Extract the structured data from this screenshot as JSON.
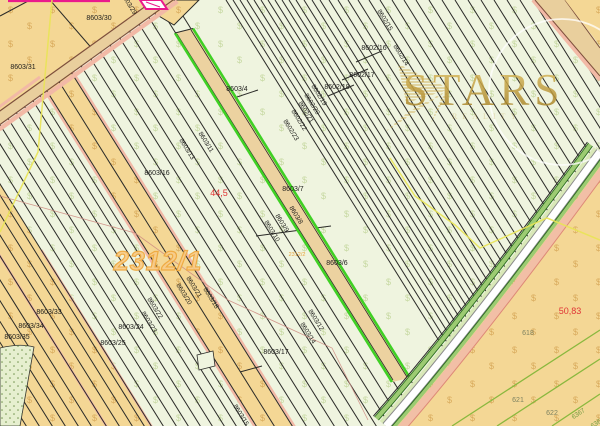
{
  "watermark": {
    "title": "STARS",
    "subtitle": "REALITY"
  },
  "map": {
    "texture_symbol": "$",
    "zone_number": "2312/1",
    "highlighted_parcel": "8603/8",
    "colors": {
      "field": "#eff4df",
      "orchard": "#f4d795",
      "road_fill": "#e9cf9d",
      "road_edge": "#7d4f3c",
      "pink_edge": "#f2b9a6",
      "magenta": "#ea1a8c",
      "highlight_green": "#3fd024",
      "bottom_field": "#f6dda2",
      "bottom_parcel_line": "#8ab83e",
      "gold": "#bd9833",
      "yellow_line": "#e9e455",
      "red_text": "#e03535",
      "zone_orange": "#efa93f"
    },
    "labels": [
      {
        "t": "8603/30",
        "x": 99,
        "y": 19,
        "r": 0,
        "s": "std"
      },
      {
        "t": "8603/31",
        "x": 23,
        "y": 68,
        "r": 0,
        "s": "std"
      },
      {
        "t": "8603/16",
        "x": 157,
        "y": 174,
        "r": 0,
        "s": "std"
      },
      {
        "t": "8603/4",
        "x": 237,
        "y": 90,
        "r": 0,
        "s": "std"
      },
      {
        "t": "8603/7",
        "x": 293,
        "y": 190,
        "r": 0,
        "s": "std"
      },
      {
        "t": "8603/6",
        "x": 337,
        "y": 264,
        "r": 0,
        "s": "std"
      },
      {
        "t": "8602/16",
        "x": 374,
        "y": 49,
        "r": 0,
        "s": "std"
      },
      {
        "t": "8602/17",
        "x": 362,
        "y": 76,
        "r": 0,
        "s": "std"
      },
      {
        "t": "8602/18",
        "x": 337,
        "y": 88,
        "r": 0,
        "s": "std"
      },
      {
        "t": "8603/17",
        "x": 276,
        "y": 353,
        "r": 0,
        "s": "std"
      },
      {
        "t": "8603/24",
        "x": 131,
        "y": 328,
        "r": 0,
        "s": "std"
      },
      {
        "t": "8603/25",
        "x": 113,
        "y": 344,
        "r": 0,
        "s": "std"
      },
      {
        "t": "8603/33",
        "x": 49,
        "y": 313,
        "r": 0,
        "s": "std"
      },
      {
        "t": "8603/34",
        "x": 31,
        "y": 327,
        "r": 0,
        "s": "std"
      },
      {
        "t": "8603/35",
        "x": 17,
        "y": 338,
        "r": 0,
        "s": "std"
      },
      {
        "t": "618",
        "x": 528,
        "y": 334,
        "r": 0,
        "s": "olive"
      },
      {
        "t": "621",
        "x": 518,
        "y": 401,
        "r": 0,
        "s": "olive"
      },
      {
        "t": "622",
        "x": 552,
        "y": 414,
        "r": 0,
        "s": "olive"
      },
      {
        "t": "8602/15",
        "x": 384,
        "y": 21,
        "r": 58,
        "s": "rot"
      },
      {
        "t": "8602/14",
        "x": 400,
        "y": 56,
        "r": 58,
        "s": "rot"
      },
      {
        "t": "8602/19",
        "x": 318,
        "y": 96,
        "r": 58,
        "s": "rot"
      },
      {
        "t": "8602/20",
        "x": 311,
        "y": 105,
        "r": 58,
        "s": "rot"
      },
      {
        "t": "8602/21",
        "x": 305,
        "y": 113,
        "r": 58,
        "s": "rot"
      },
      {
        "t": "8602/22",
        "x": 298,
        "y": 121,
        "r": 58,
        "s": "rot"
      },
      {
        "t": "8602/23",
        "x": 290,
        "y": 131,
        "r": 58,
        "s": "rot"
      },
      {
        "t": "8603/29",
        "x": 128,
        "y": 5,
        "r": 58,
        "s": "rot"
      },
      {
        "t": "8603/13",
        "x": 186,
        "y": 150,
        "r": 58,
        "s": "rot"
      },
      {
        "t": "8603/11",
        "x": 205,
        "y": 143,
        "r": 58,
        "s": "rot"
      },
      {
        "t": "8603/8",
        "x": 295,
        "y": 216,
        "r": 58,
        "s": "rot"
      },
      {
        "t": "8603/9",
        "x": 281,
        "y": 224,
        "r": 58,
        "s": "rot"
      },
      {
        "t": "8603/10",
        "x": 271,
        "y": 232,
        "r": 58,
        "s": "rot"
      },
      {
        "t": "8603/12",
        "x": 315,
        "y": 321,
        "r": 58,
        "s": "rot"
      },
      {
        "t": "8603/14",
        "x": 307,
        "y": 334,
        "r": 58,
        "s": "rot"
      },
      {
        "t": "8603/18",
        "x": 210,
        "y": 299,
        "r": 58,
        "s": "rot"
      },
      {
        "t": "8603/21",
        "x": 193,
        "y": 288,
        "r": 58,
        "s": "rot"
      },
      {
        "t": "8603/20",
        "x": 183,
        "y": 295,
        "r": 58,
        "s": "rot"
      },
      {
        "t": "8603/22",
        "x": 154,
        "y": 309,
        "r": 58,
        "s": "rot"
      },
      {
        "t": "8603/23",
        "x": 148,
        "y": 323,
        "r": 58,
        "s": "rot"
      },
      {
        "t": "8603/15",
        "x": 240,
        "y": 416,
        "r": 58,
        "s": "rot"
      },
      {
        "t": "6367",
        "x": 579,
        "y": 415,
        "r": -33,
        "s": "green"
      },
      {
        "t": "6368",
        "x": 598,
        "y": 424,
        "r": -33,
        "s": "green"
      },
      {
        "t": "44,5",
        "x": 219,
        "y": 194,
        "r": 0,
        "s": "red"
      },
      {
        "t": "50,83",
        "x": 570,
        "y": 312,
        "r": 0,
        "s": "red"
      },
      {
        "t": "2312/1",
        "x": 158,
        "y": 263,
        "r": 0,
        "s": "zoneBig"
      },
      {
        "t": "2312/2",
        "x": 297,
        "y": 256,
        "r": 0,
        "s": "zoneSmall"
      }
    ]
  }
}
